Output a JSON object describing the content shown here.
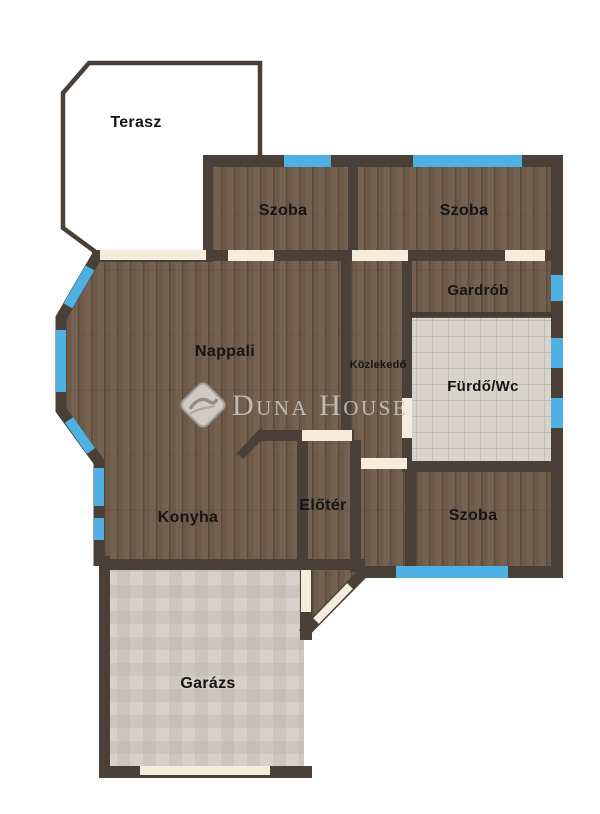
{
  "plan": {
    "title": "Floor plan",
    "brand": "Duna House",
    "rooms": {
      "terasz": {
        "label": "Terasz"
      },
      "szoba1": {
        "label": "Szoba"
      },
      "szoba2": {
        "label": "Szoba"
      },
      "gardrob": {
        "label": "Gardrób"
      },
      "nappali": {
        "label": "Nappali"
      },
      "kozlekedo": {
        "label": "Közlekedő"
      },
      "furdo": {
        "label": "Fürdő/Wc"
      },
      "konyha": {
        "label": "Konyha"
      },
      "eloter": {
        "label": "Előtér"
      },
      "szoba3": {
        "label": "Szoba"
      },
      "garazs": {
        "label": "Garázs"
      }
    },
    "colors": {
      "wall": "#4a4038",
      "wood_floor": "#6e5a49",
      "tile_floor": "#d8d3cb",
      "garage_floor": "#ccc6be",
      "window": "#4fb0e4",
      "door": "#f6ecdc",
      "watermark": "#c9c5c0"
    }
  }
}
